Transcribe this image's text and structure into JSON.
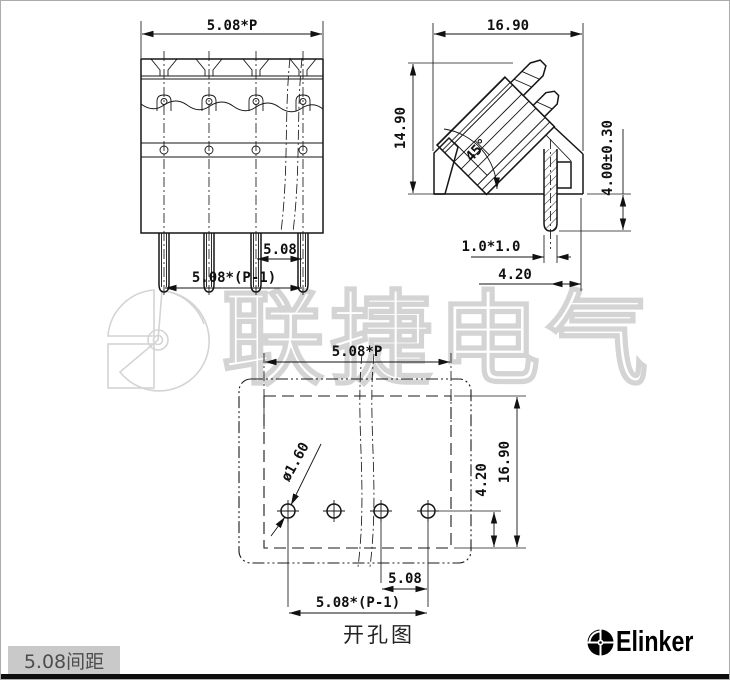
{
  "colors": {
    "line": "#161616",
    "watermark": "#d4d4d4",
    "footer_box_bg": "#c9c9c9",
    "footer_box_text": "#4d4d4d",
    "brand": "#000000"
  },
  "watermark": {
    "text": "联捷电气"
  },
  "front_view": {
    "pitch_total": "5.08*P",
    "pitch": "5.08",
    "span": "5.08*(P-1)"
  },
  "side_view": {
    "width": "16.90",
    "height": "14.90",
    "angle": "45°",
    "pin_length": "4.00±0.30",
    "pin_section": "1.0*1.0",
    "pin_offset": "4.20"
  },
  "hole_view": {
    "pitch_total": "5.08*P",
    "hole_dia": "ø1.60",
    "row_offset": "4.20",
    "depth": "16.90",
    "pitch": "5.08",
    "span": "5.08*(P-1)",
    "caption": "开孔图"
  },
  "footer": {
    "pitch_label": "5.08间距",
    "brand": "Elinker"
  }
}
